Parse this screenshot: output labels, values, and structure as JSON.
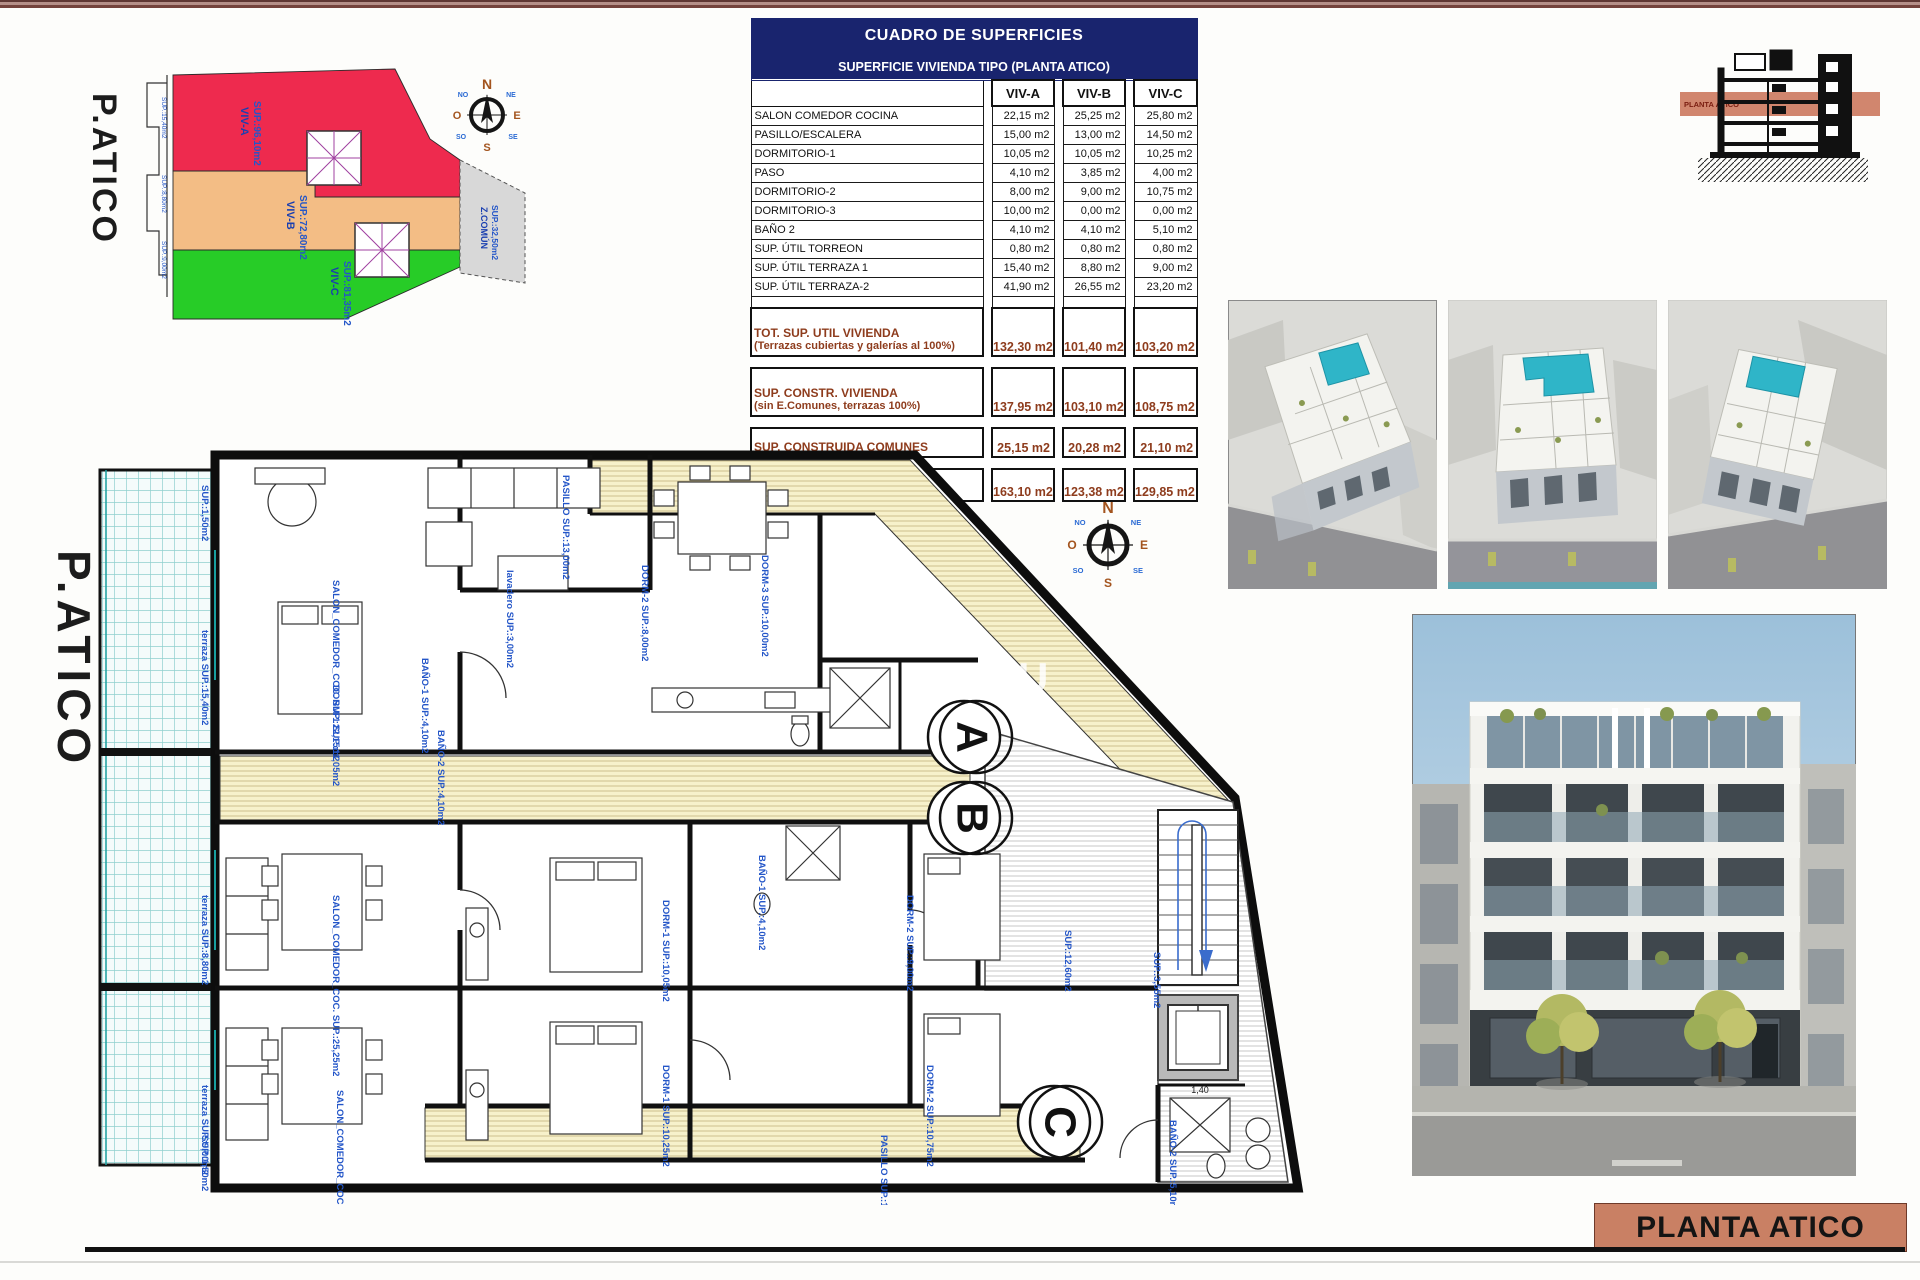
{
  "colors": {
    "header_navy": "#19246e",
    "totals_brick": "#8e3c1d",
    "title_block_salmon": "#c98064",
    "zone_red": "#ee2a4e",
    "zone_orange": "#f3bd85",
    "zone_green": "#27cc27",
    "zone_gray": "#d8d8d8",
    "plan_label_blue": "#2456c8",
    "terrace_teal": "#8fd0ce",
    "pool_teal": "#2fb5c8"
  },
  "surface_table": {
    "title": "CUADRO DE SUPERFICIES",
    "subtitle": "SUPERFICIE VIVIENDA TIPO  (PLANTA ATICO)",
    "columns": [
      "VIV-A",
      "VIV-B",
      "VIV-C"
    ],
    "rows": [
      {
        "label": "SALON COMEDOR COCINA",
        "a": "22,15 m2",
        "b": "25,25 m2",
        "c": "25,80 m2"
      },
      {
        "label": "PASILLO/ESCALERA",
        "a": "15,00 m2",
        "b": "13,00 m2",
        "c": "14,50 m2"
      },
      {
        "label": "DORMITORIO-1",
        "a": "10,05 m2",
        "b": "10,05 m2",
        "c": "10,25 m2"
      },
      {
        "label": "PASO",
        "a": "4,10 m2",
        "b": "3,85 m2",
        "c": "4,00 m2"
      },
      {
        "label": "DORMITORIO-2",
        "a": "8,00 m2",
        "b": "9,00 m2",
        "c": "10,75 m2"
      },
      {
        "label": "DORMITORIO-3",
        "a": "10,00 m2",
        "b": "0,00 m2",
        "c": "0,00 m2"
      },
      {
        "label": "BAÑO 2",
        "a": "4,10 m2",
        "b": "4,10 m2",
        "c": "5,10 m2"
      },
      {
        "label": "SUP. ÚTIL TORREON",
        "a": "0,80 m2",
        "b": "0,80 m2",
        "c": "0,80 m2"
      },
      {
        "label": "SUP. ÚTIL TERRAZA 1",
        "a": "15,40 m2",
        "b": "8,80 m2",
        "c": "9,00 m2"
      },
      {
        "label": "SUP. ÚTIL TERRAZA-2",
        "a": "41,90 m2",
        "b": "26,55 m2",
        "c": "23,20 m2"
      }
    ],
    "totals": [
      {
        "label": "TOT. SUP. UTIL VIVIENDA",
        "note": "(Terrazas cubiertas y galerías al 100%)",
        "a": "132,30 m2",
        "b": "101,40 m2",
        "c": "103,20 m2"
      },
      {
        "label": "SUP. CONSTR. VIVIENDA",
        "note": "(sin E.Comunes, terrazas 100%)",
        "a": "137,95 m2",
        "b": "103,10 m2",
        "c": "108,75 m2"
      },
      {
        "label": "SUP. CONSTRUIDA COMUNES",
        "note": "",
        "a": "25,15 m2",
        "b": "20,28 m2",
        "c": "21,10 m2"
      },
      {
        "label": "SUPERFIIE CONSTRUIDA TOTAL",
        "note": "",
        "a": "163,10 m2",
        "b": "123,38 m2",
        "c": "129,85 m2"
      }
    ]
  },
  "site_plan": {
    "title": "P.ATICO",
    "zones": [
      {
        "label": "VIV-A",
        "sup": "SUP.:96,10m2"
      },
      {
        "label": "VIV-B",
        "sup": "SUP.:72,80m2"
      },
      {
        "label": "VIV-C",
        "sup": "SUP.:81,35m2"
      },
      {
        "label": "Z.COMÚN",
        "sup": "SUP.:32,50m2"
      }
    ],
    "strip_labels": [
      "SUP.:15,40m2",
      "SUP.:8,80m2",
      "SUP.:9,00m2"
    ]
  },
  "compass": {
    "n": "N",
    "s": "S",
    "e": "E",
    "o": "O",
    "ne": "NE",
    "no": "NO",
    "se": "SE",
    "so": "SO"
  },
  "floor_plan": {
    "title": "P.ATICO",
    "watermark": "SU",
    "marks": [
      "A",
      "B",
      "C"
    ],
    "dim": "1,40",
    "labels": [
      "PASILLO SUP.:13,00m2",
      "SALON_COMEDOR_COC. SUP.:22,15m2",
      "terraza SUP.:15,40m2",
      "DORM-1 SUP.:11,05m2",
      "BAÑO-1 SUP.:4,10m2",
      "BAÑO-2 SUP.:4,10m2",
      "lavadero SUP.:3,00m2",
      "DORM-2 SUP.:8,00m2",
      "DORM-3 SUP.:10,00m2",
      "SALON_COMEDOR_COC. SUP.:25,25m2",
      "terraza SUP.:8,80m2",
      "DORM-1 SUP.:10,05m2",
      "DORM-2 SUP.:9,00m2",
      "BAÑO-1 SUP.:4,10m2",
      "SALON_COMEDOR_COC. SUP.:25,80m2",
      "terraza SUP.:9,00m2",
      "DORM-1 SUP.:10,25m2",
      "DORM-2 SUP.:10,75m2",
      "BAÑO-2 SUP.:5,10m2",
      "PASILLO SUP.:11,75m2",
      "SUP.:12,60m2",
      "SUP.:3,55m2",
      "SUP.:1,50m2",
      "SUP.:1,50m2"
    ]
  },
  "elevation": {
    "label": "PLANTA ÁTICO"
  },
  "title_block": {
    "label": "PLANTA ATICO"
  }
}
